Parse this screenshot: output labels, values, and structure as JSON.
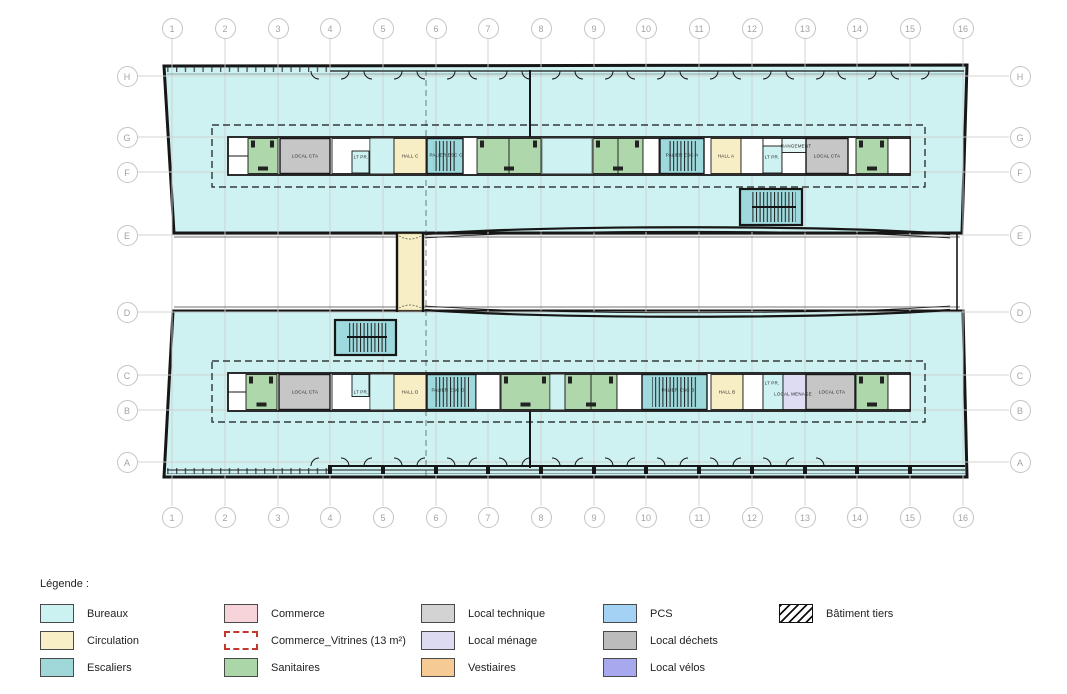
{
  "plan": {
    "grid": {
      "columns": [
        {
          "label": "1",
          "x": 172
        },
        {
          "label": "2",
          "x": 225
        },
        {
          "label": "3",
          "x": 278
        },
        {
          "label": "4",
          "x": 330
        },
        {
          "label": "5",
          "x": 383
        },
        {
          "label": "6",
          "x": 436
        },
        {
          "label": "7",
          "x": 488
        },
        {
          "label": "8",
          "x": 541
        },
        {
          "label": "9",
          "x": 594
        },
        {
          "label": "10",
          "x": 646
        },
        {
          "label": "11",
          "x": 699
        },
        {
          "label": "12",
          "x": 752
        },
        {
          "label": "13",
          "x": 805
        },
        {
          "label": "14",
          "x": 857
        },
        {
          "label": "15",
          "x": 910
        },
        {
          "label": "16",
          "x": 963
        }
      ],
      "rows": [
        {
          "label": "H",
          "y": 76
        },
        {
          "label": "G",
          "y": 137
        },
        {
          "label": "F",
          "y": 172
        },
        {
          "label": "E",
          "y": 235
        },
        {
          "label": "D",
          "y": 312
        },
        {
          "label": "C",
          "y": 375
        },
        {
          "label": "B",
          "y": 410
        },
        {
          "label": "A",
          "y": 462
        }
      ]
    },
    "rooms": [
      {
        "label": "LOCAL CTA",
        "x": 305,
        "y": 156
      },
      {
        "label": "LT PR.",
        "x": 361,
        "y": 157
      },
      {
        "label": "HALL C",
        "x": 410,
        "y": 156
      },
      {
        "label": "PALIER ESC C",
        "x": 446,
        "y": 155
      },
      {
        "label": "PALIER ESC A",
        "x": 682,
        "y": 155
      },
      {
        "label": "HALL A",
        "x": 726,
        "y": 156
      },
      {
        "label": "LT PR.",
        "x": 772,
        "y": 157
      },
      {
        "label": "RANGEMENT",
        "x": 796,
        "y": 146
      },
      {
        "label": "LOCAL CTA",
        "x": 827,
        "y": 156
      },
      {
        "label": "LOCAL CTA",
        "x": 305,
        "y": 392
      },
      {
        "label": "LT PR.",
        "x": 361,
        "y": 392
      },
      {
        "label": "HALL D",
        "x": 410,
        "y": 392
      },
      {
        "label": "PALIER ESC D",
        "x": 448,
        "y": 390
      },
      {
        "label": "PALIER ESC B",
        "x": 678,
        "y": 390
      },
      {
        "label": "HALL B",
        "x": 727,
        "y": 392
      },
      {
        "label": "LT PR.",
        "x": 772,
        "y": 383
      },
      {
        "label": "LOCAL MENAGE",
        "x": 793,
        "y": 394
      },
      {
        "label": "LOCAL CTA",
        "x": 832,
        "y": 392
      }
    ],
    "legend": {
      "title": "Légende :",
      "columns": [
        {
          "x": 40,
          "items": [
            {
              "label": "Bureaux",
              "swatch": "fill",
              "color": "#cbf1f0"
            },
            {
              "label": "Circulation",
              "swatch": "fill",
              "color": "#f9efc6"
            },
            {
              "label": "Escaliers",
              "swatch": "fill",
              "color": "#a0d8da"
            }
          ]
        },
        {
          "x": 224,
          "items": [
            {
              "label": "Commerce",
              "swatch": "fill",
              "color": "#f7d4d9"
            },
            {
              "label": "Commerce_Vitrines (13 m²)",
              "swatch": "dashed",
              "color": "#ffffff"
            },
            {
              "label": "Sanitaires",
              "swatch": "fill",
              "color": "#abd6a8"
            }
          ]
        },
        {
          "x": 421,
          "items": [
            {
              "label": "Local technique",
              "swatch": "fill",
              "color": "#d3d3d3"
            },
            {
              "label": "Local ménage",
              "swatch": "fill",
              "color": "#dcdbf1"
            },
            {
              "label": "Vestiaires",
              "swatch": "fill",
              "color": "#f5ca94"
            }
          ]
        },
        {
          "x": 603,
          "items": [
            {
              "label": "PCS",
              "swatch": "fill",
              "color": "#a4d2f4"
            },
            {
              "label": "Local déchets",
              "swatch": "fill",
              "color": "#bcbcbc"
            },
            {
              "label": "Local vélos",
              "swatch": "fill",
              "color": "#a8a8ee"
            }
          ]
        },
        {
          "x": 779,
          "items": [
            {
              "label": "Bâtiment tiers",
              "swatch": "hatch",
              "color": "#000000"
            }
          ]
        }
      ]
    },
    "colors": {
      "bureaux": "#cdf2f1",
      "circulation": "#f8eec5",
      "escaliers": "#9edadd",
      "sanitaires": "#aed8ab",
      "technique": "#c6c6c6",
      "menage": "#dedcf2",
      "walls": "#161616",
      "gridline": "#cfcfcf"
    }
  }
}
